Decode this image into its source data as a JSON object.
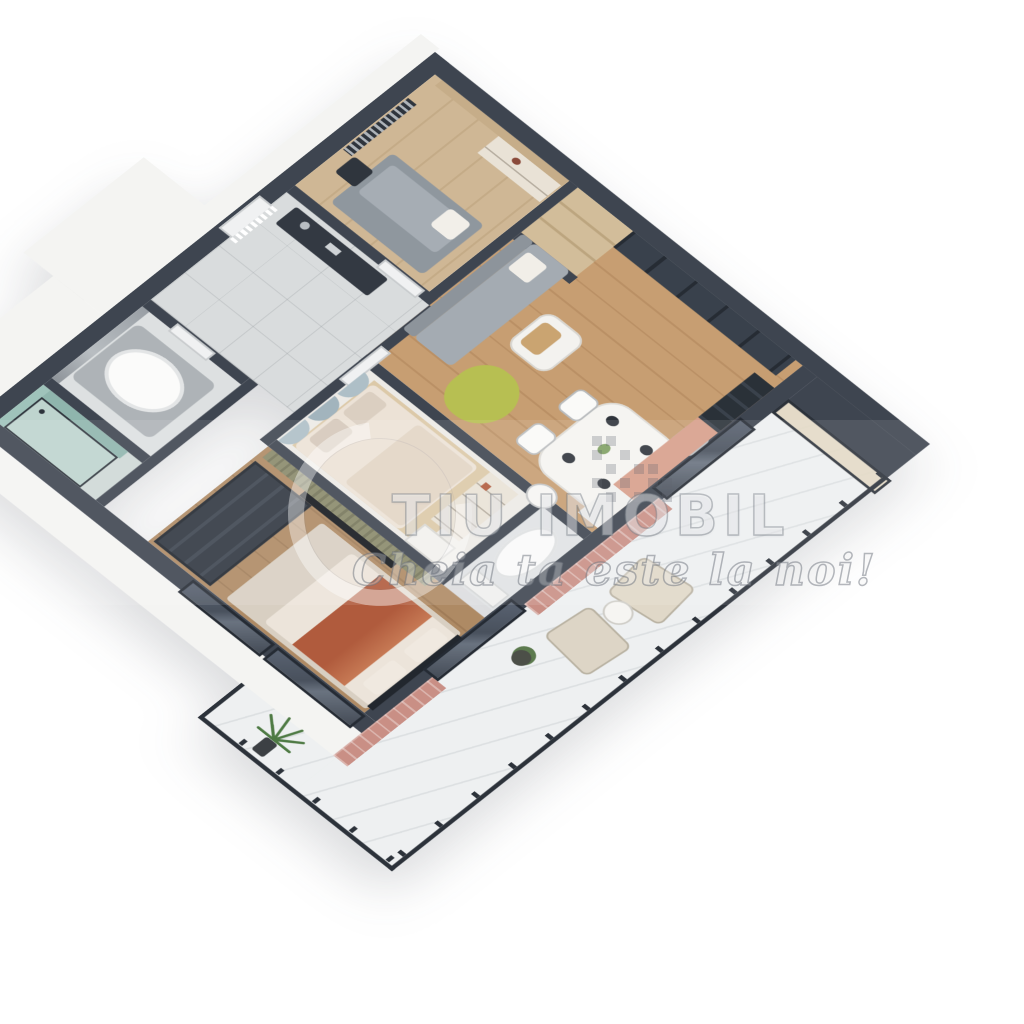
{
  "watermark": {
    "brand_text": "TIU IMOBIL",
    "tagline": "Cheia ta este la noi!",
    "logo_icon": "swoosh-circle-icon",
    "pixel_motif_icon": "pixel-buildings-icon"
  },
  "palette": {
    "background": "#ffffff",
    "wall_charcoal": "#3e4550",
    "wall_exterior_white": "#f4f4f2",
    "floor_oak_living": "#c79e72",
    "floor_oak_master": "#ae8a64",
    "floor_wood_office": "#cfb795",
    "floor_tile_hall": "#d9dcdd",
    "floor_marble_balcony": "#eef0f1",
    "accent_brick": "#c98f85",
    "accent_clay_panel": "#d79f8b",
    "accent_lime_beanbag": "#b7bf52",
    "accent_teal_shower": "#9fc3bb",
    "accent_rust_throw": "#b05b3d",
    "railing_metal": "#2c323a",
    "headboard_blue_gray": "#aebfc7",
    "sofa_gray": "#9ba2a9"
  }
}
